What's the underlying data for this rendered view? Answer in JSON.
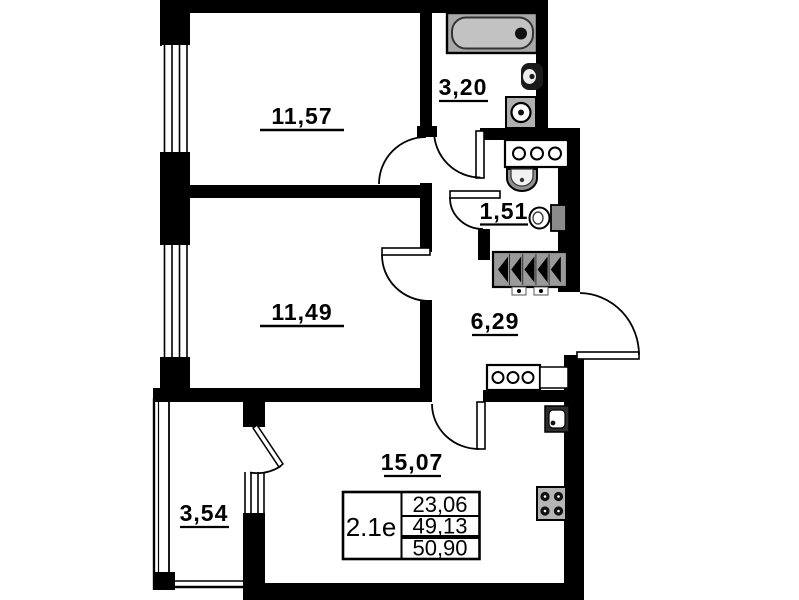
{
  "plan": {
    "rooms": [
      {
        "name": "bedroom-top",
        "area": "11,57"
      },
      {
        "name": "bedroom-middle",
        "area": "11,49"
      },
      {
        "name": "bathroom",
        "area": "3,20"
      },
      {
        "name": "wc",
        "area": "1,51"
      },
      {
        "name": "hallway",
        "area": "6,29"
      },
      {
        "name": "kitchen-living-room",
        "area": "15,07"
      },
      {
        "name": "balcony",
        "area": "3,54"
      }
    ],
    "info_box": {
      "unit_label": "2.1е",
      "values": [
        "23,06",
        "49,13",
        "50,90"
      ]
    },
    "fixtures": [
      "bathtub",
      "toilet",
      "washbasin",
      "sink",
      "counter-3-rings",
      "ventilation-shaft",
      "kitchen-sink",
      "stove-4-burners"
    ],
    "colors": {
      "walls": "#000000",
      "fixture_gray": "#a8a8a8",
      "background": "#ffffff"
    }
  }
}
